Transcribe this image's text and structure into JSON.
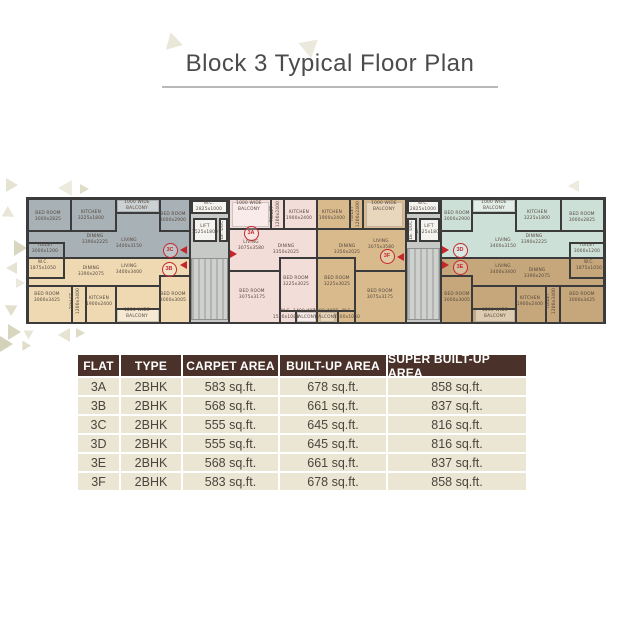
{
  "title": "Block 3 Typical Floor Plan",
  "colors": {
    "accent_red": "#c4262b",
    "wall": "#3b3b3b",
    "table_header_bg": "#4a322b",
    "table_row_bg": "#eae6d3",
    "title_text": "#4b4b4d"
  },
  "table": {
    "headers": [
      "FLAT",
      "TYPE",
      "CARPET AREA",
      "BUILT-UP AREA",
      "SUPER BUILT-UP AREA"
    ],
    "rows": [
      [
        "3A",
        "2BHK",
        "583 sq.ft.",
        "678 sq.ft.",
        "858 sq.ft."
      ],
      [
        "3B",
        "2BHK",
        "568 sq.ft.",
        "661 sq.ft.",
        "837 sq.ft."
      ],
      [
        "3C",
        "2BHK",
        "555 sq.ft.",
        "645 sq.ft.",
        "816 sq.ft."
      ],
      [
        "3D",
        "2BHK",
        "555 sq.ft.",
        "645 sq.ft.",
        "816 sq.ft."
      ],
      [
        "3E",
        "2BHK",
        "568 sq.ft.",
        "661 sq.ft.",
        "837 sq.ft."
      ],
      [
        "3F",
        "2BHK",
        "583 sq.ft.",
        "678 sq.ft.",
        "858 sq.ft."
      ]
    ]
  },
  "plan": {
    "flats": [
      {
        "id": "3C",
        "color": "#a8b1b5",
        "x": 0,
        "y": 0,
        "w": 160,
        "h": 57
      },
      {
        "id": "3B",
        "color": "#eed9b3",
        "x": 0,
        "y": 57,
        "w": 160,
        "h": 65
      },
      {
        "id": "3A",
        "color": "#f3ddd9",
        "x": 201,
        "y": 0,
        "w": 86,
        "h": 122
      },
      {
        "id": "3F",
        "color": "#d9ba8d",
        "x": 289,
        "y": 0,
        "w": 87,
        "h": 122
      },
      {
        "id": "3D",
        "color": "#cde0d8",
        "x": 413,
        "y": 0,
        "w": 161,
        "h": 57
      },
      {
        "id": "3E",
        "color": "#c6a77b",
        "x": 413,
        "y": 57,
        "w": 161,
        "h": 65
      }
    ],
    "cores": [
      {
        "x": 160,
        "y": 0,
        "w": 41,
        "h": 122
      },
      {
        "x": 376,
        "y": 0,
        "w": 37,
        "h": 122
      }
    ],
    "stairs": [
      [
        162,
        58,
        37,
        62
      ],
      [
        378,
        48,
        33,
        72
      ]
    ],
    "core_boxes": [
      [
        162,
        0,
        37,
        14
      ],
      [
        164,
        18,
        24,
        24
      ],
      [
        190,
        18,
        9,
        24
      ],
      [
        378,
        0,
        33,
        14
      ],
      [
        378,
        18,
        10,
        24
      ],
      [
        390,
        18,
        21,
        24
      ]
    ],
    "overlays": [
      [
        88,
        0,
        42,
        12
      ],
      [
        444,
        0,
        42,
        12
      ],
      [
        203,
        2,
        37,
        25
      ],
      [
        337,
        2,
        37,
        25
      ],
      [
        88,
        108,
        42,
        14
      ],
      [
        446,
        108,
        40,
        14
      ],
      [
        268,
        112,
        19,
        10
      ],
      [
        291,
        112,
        15,
        10
      ]
    ],
    "walls": [
      [
        160,
        0,
        2,
        122
      ],
      [
        199,
        0,
        2,
        122
      ],
      [
        287,
        0,
        2,
        122
      ],
      [
        376,
        0,
        2,
        122
      ],
      [
        411,
        0,
        2,
        122
      ],
      [
        0,
        57,
        160,
        2
      ],
      [
        413,
        57,
        161,
        2
      ],
      [
        41,
        0,
        2,
        30
      ],
      [
        0,
        30,
        88,
        2
      ],
      [
        86,
        0,
        2,
        30
      ],
      [
        86,
        12,
        44,
        2
      ],
      [
        130,
        0,
        2,
        30
      ],
      [
        130,
        30,
        30,
        2
      ],
      [
        0,
        42,
        34,
        2
      ],
      [
        34,
        42,
        2,
        15
      ],
      [
        0,
        77,
        34,
        2
      ],
      [
        34,
        57,
        2,
        22
      ],
      [
        0,
        85,
        130,
        2
      ],
      [
        42,
        85,
        2,
        37
      ],
      [
        56,
        85,
        2,
        37
      ],
      [
        86,
        85,
        2,
        37
      ],
      [
        86,
        108,
        44,
        2
      ],
      [
        130,
        75,
        2,
        47
      ],
      [
        130,
        75,
        30,
        2
      ],
      [
        201,
        28,
        86,
        2
      ],
      [
        241,
        0,
        2,
        28
      ],
      [
        254,
        0,
        2,
        28
      ],
      [
        201,
        70,
        51,
        2
      ],
      [
        250,
        57,
        2,
        65
      ],
      [
        250,
        57,
        37,
        2
      ],
      [
        250,
        110,
        37,
        2
      ],
      [
        266,
        110,
        2,
        12
      ],
      [
        289,
        28,
        87,
        2
      ],
      [
        320,
        0,
        2,
        28
      ],
      [
        333,
        0,
        2,
        28
      ],
      [
        325,
        70,
        51,
        2
      ],
      [
        325,
        57,
        2,
        65
      ],
      [
        289,
        57,
        38,
        2
      ],
      [
        289,
        110,
        38,
        2
      ],
      [
        308,
        110,
        2,
        12
      ],
      [
        531,
        0,
        2,
        30
      ],
      [
        486,
        0,
        2,
        30
      ],
      [
        486,
        30,
        88,
        2
      ],
      [
        444,
        12,
        44,
        2
      ],
      [
        442,
        0,
        2,
        30
      ],
      [
        413,
        30,
        31,
        2
      ],
      [
        540,
        42,
        34,
        2
      ],
      [
        540,
        42,
        2,
        15
      ],
      [
        540,
        77,
        34,
        2
      ],
      [
        540,
        57,
        2,
        22
      ],
      [
        444,
        85,
        130,
        2
      ],
      [
        530,
        85,
        2,
        37
      ],
      [
        516,
        85,
        2,
        37
      ],
      [
        486,
        85,
        2,
        37
      ],
      [
        444,
        108,
        44,
        2
      ],
      [
        442,
        75,
        2,
        47
      ],
      [
        413,
        75,
        31,
        2
      ]
    ],
    "labels": [
      {
        "t": "BED ROOM",
        "d": "3000x2825",
        "x": 19,
        "y": 17
      },
      {
        "t": "KITCHEN",
        "d": "3225x1800",
        "x": 62,
        "y": 16
      },
      {
        "t": "1000 WIDE",
        "d": "BALCONY",
        "x": 108,
        "y": 6
      },
      {
        "t": "BED ROOM",
        "d": "3000x2900",
        "x": 144,
        "y": 18
      },
      {
        "t": "DINING",
        "d": "3390x2225",
        "x": 66,
        "y": 40
      },
      {
        "t": "LIVING",
        "d": "3400x3150",
        "x": 100,
        "y": 44
      },
      {
        "t": "TOILET",
        "d": "3000x1200",
        "x": 16,
        "y": 49
      },
      {
        "t": "W.C.",
        "d": "2825x1000",
        "x": 180,
        "y": 7
      },
      {
        "t": "LIFT",
        "d": "1525x1800",
        "x": 176,
        "y": 30
      },
      {
        "t": "ELE. DUCT",
        "d": "",
        "x": 194,
        "y": 30,
        "v": 1
      },
      {
        "t": "W.C.",
        "d": "1875x1050",
        "x": 14,
        "y": 66
      },
      {
        "t": "DINING",
        "d": "3390x2075",
        "x": 62,
        "y": 72
      },
      {
        "t": "LIVING",
        "d": "3400x3400",
        "x": 100,
        "y": 70
      },
      {
        "t": "BED ROOM",
        "d": "3000x3425",
        "x": 18,
        "y": 98
      },
      {
        "t": "TOILET",
        "d": "1200x3400",
        "x": 47,
        "y": 101,
        "v": 1
      },
      {
        "t": "KITCHEN",
        "d": "1900x2400",
        "x": 70,
        "y": 102
      },
      {
        "t": "1200 WIDE",
        "d": "BALCONY",
        "x": 108,
        "y": 114
      },
      {
        "t": "BED ROOM",
        "d": "3000x3005",
        "x": 144,
        "y": 98
      },
      {
        "t": "1000 WIDE",
        "d": "BALCONY",
        "x": 220,
        "y": 7
      },
      {
        "t": "TOILET",
        "d": "1200x2400",
        "x": 247,
        "y": 14,
        "v": 1
      },
      {
        "t": "KITCHEN",
        "d": "1900x2400",
        "x": 270,
        "y": 16
      },
      {
        "t": "LIVING",
        "d": "3075x3580",
        "x": 222,
        "y": 46
      },
      {
        "t": "DINING",
        "d": "3350x2025",
        "x": 257,
        "y": 50
      },
      {
        "t": "BED ROOM",
        "d": "3075x3175",
        "x": 223,
        "y": 95
      },
      {
        "t": "BED ROOM",
        "d": "3225x3025",
        "x": 267,
        "y": 82
      },
      {
        "t": "W.C.",
        "d": "1500x1088",
        "x": 257,
        "y": 115
      },
      {
        "t": "1400 WIDE",
        "d": "BALCONY",
        "x": 277,
        "y": 115
      },
      {
        "t": "KITCHEN",
        "d": "1900x2400",
        "x": 303,
        "y": 16
      },
      {
        "t": "TOILET",
        "d": "1200x2400",
        "x": 327,
        "y": 14,
        "v": 1
      },
      {
        "t": "1000 WIDE",
        "d": "BALCONY",
        "x": 355,
        "y": 7
      },
      {
        "t": "DINING",
        "d": "3350x2025",
        "x": 318,
        "y": 50
      },
      {
        "t": "LIVING",
        "d": "3075x3580",
        "x": 352,
        "y": 45
      },
      {
        "t": "BED ROOM",
        "d": "3225x3025",
        "x": 308,
        "y": 82
      },
      {
        "t": "BED ROOM",
        "d": "3075x3175",
        "x": 351,
        "y": 95
      },
      {
        "t": "1400 WIDE",
        "d": "BALCONY",
        "x": 297,
        "y": 115
      },
      {
        "t": "W.C.",
        "d": "1500x1050",
        "x": 318,
        "y": 115
      },
      {
        "t": "W.C.",
        "d": "2825x1000",
        "x": 394,
        "y": 7
      },
      {
        "t": "ELE. DUCT",
        "d": "",
        "x": 383,
        "y": 30,
        "v": 1
      },
      {
        "t": "LIFT",
        "d": "1525x1800",
        "x": 400,
        "y": 30
      },
      {
        "t": "BED ROOM",
        "d": "3000x2900",
        "x": 428,
        "y": 17
      },
      {
        "t": "1000 WIDE",
        "d": "BALCONY",
        "x": 465,
        "y": 6
      },
      {
        "t": "KITCHEN",
        "d": "3225x1800",
        "x": 508,
        "y": 16
      },
      {
        "t": "BED ROOM",
        "d": "3000x2825",
        "x": 553,
        "y": 18
      },
      {
        "t": "DINING",
        "d": "3390x2225",
        "x": 505,
        "y": 40
      },
      {
        "t": "LIVING",
        "d": "3400x3150",
        "x": 474,
        "y": 44
      },
      {
        "t": "TOILET",
        "d": "3000x1200",
        "x": 558,
        "y": 49
      },
      {
        "t": "LIVING",
        "d": "3400x3400",
        "x": 474,
        "y": 70
      },
      {
        "t": "W.C.",
        "d": "1875x1050",
        "x": 560,
        "y": 66
      },
      {
        "t": "DINING",
        "d": "3390x2075",
        "x": 508,
        "y": 74
      },
      {
        "t": "BED ROOM",
        "d": "3000x3005",
        "x": 428,
        "y": 98
      },
      {
        "t": "KITCHEN",
        "d": "1900x2400",
        "x": 501,
        "y": 102
      },
      {
        "t": "TOILET",
        "d": "1200x3400",
        "x": 523,
        "y": 101,
        "v": 1
      },
      {
        "t": "1200 WIDE",
        "d": "BALCONY",
        "x": 466,
        "y": 114
      },
      {
        "t": "BED ROOM",
        "d": "3000x3425",
        "x": 553,
        "y": 98
      }
    ],
    "markers": [
      {
        "id": "3C",
        "x": 140,
        "y": 49
      },
      {
        "id": "3B",
        "x": 139,
        "y": 68
      },
      {
        "id": "3A",
        "x": 221,
        "y": 32
      },
      {
        "id": "3F",
        "x": 357,
        "y": 55
      },
      {
        "id": "3D",
        "x": 430,
        "y": 49
      },
      {
        "id": "3E",
        "x": 430,
        "y": 66
      }
    ],
    "arrows": [
      {
        "x": 155,
        "y": 50,
        "d": "l"
      },
      {
        "x": 155,
        "y": 65,
        "d": "l"
      },
      {
        "x": 204,
        "y": 54,
        "d": "r"
      },
      {
        "x": 372,
        "y": 57,
        "d": "l"
      },
      {
        "x": 416,
        "y": 50,
        "d": "r"
      },
      {
        "x": 416,
        "y": 65,
        "d": "r"
      }
    ]
  }
}
